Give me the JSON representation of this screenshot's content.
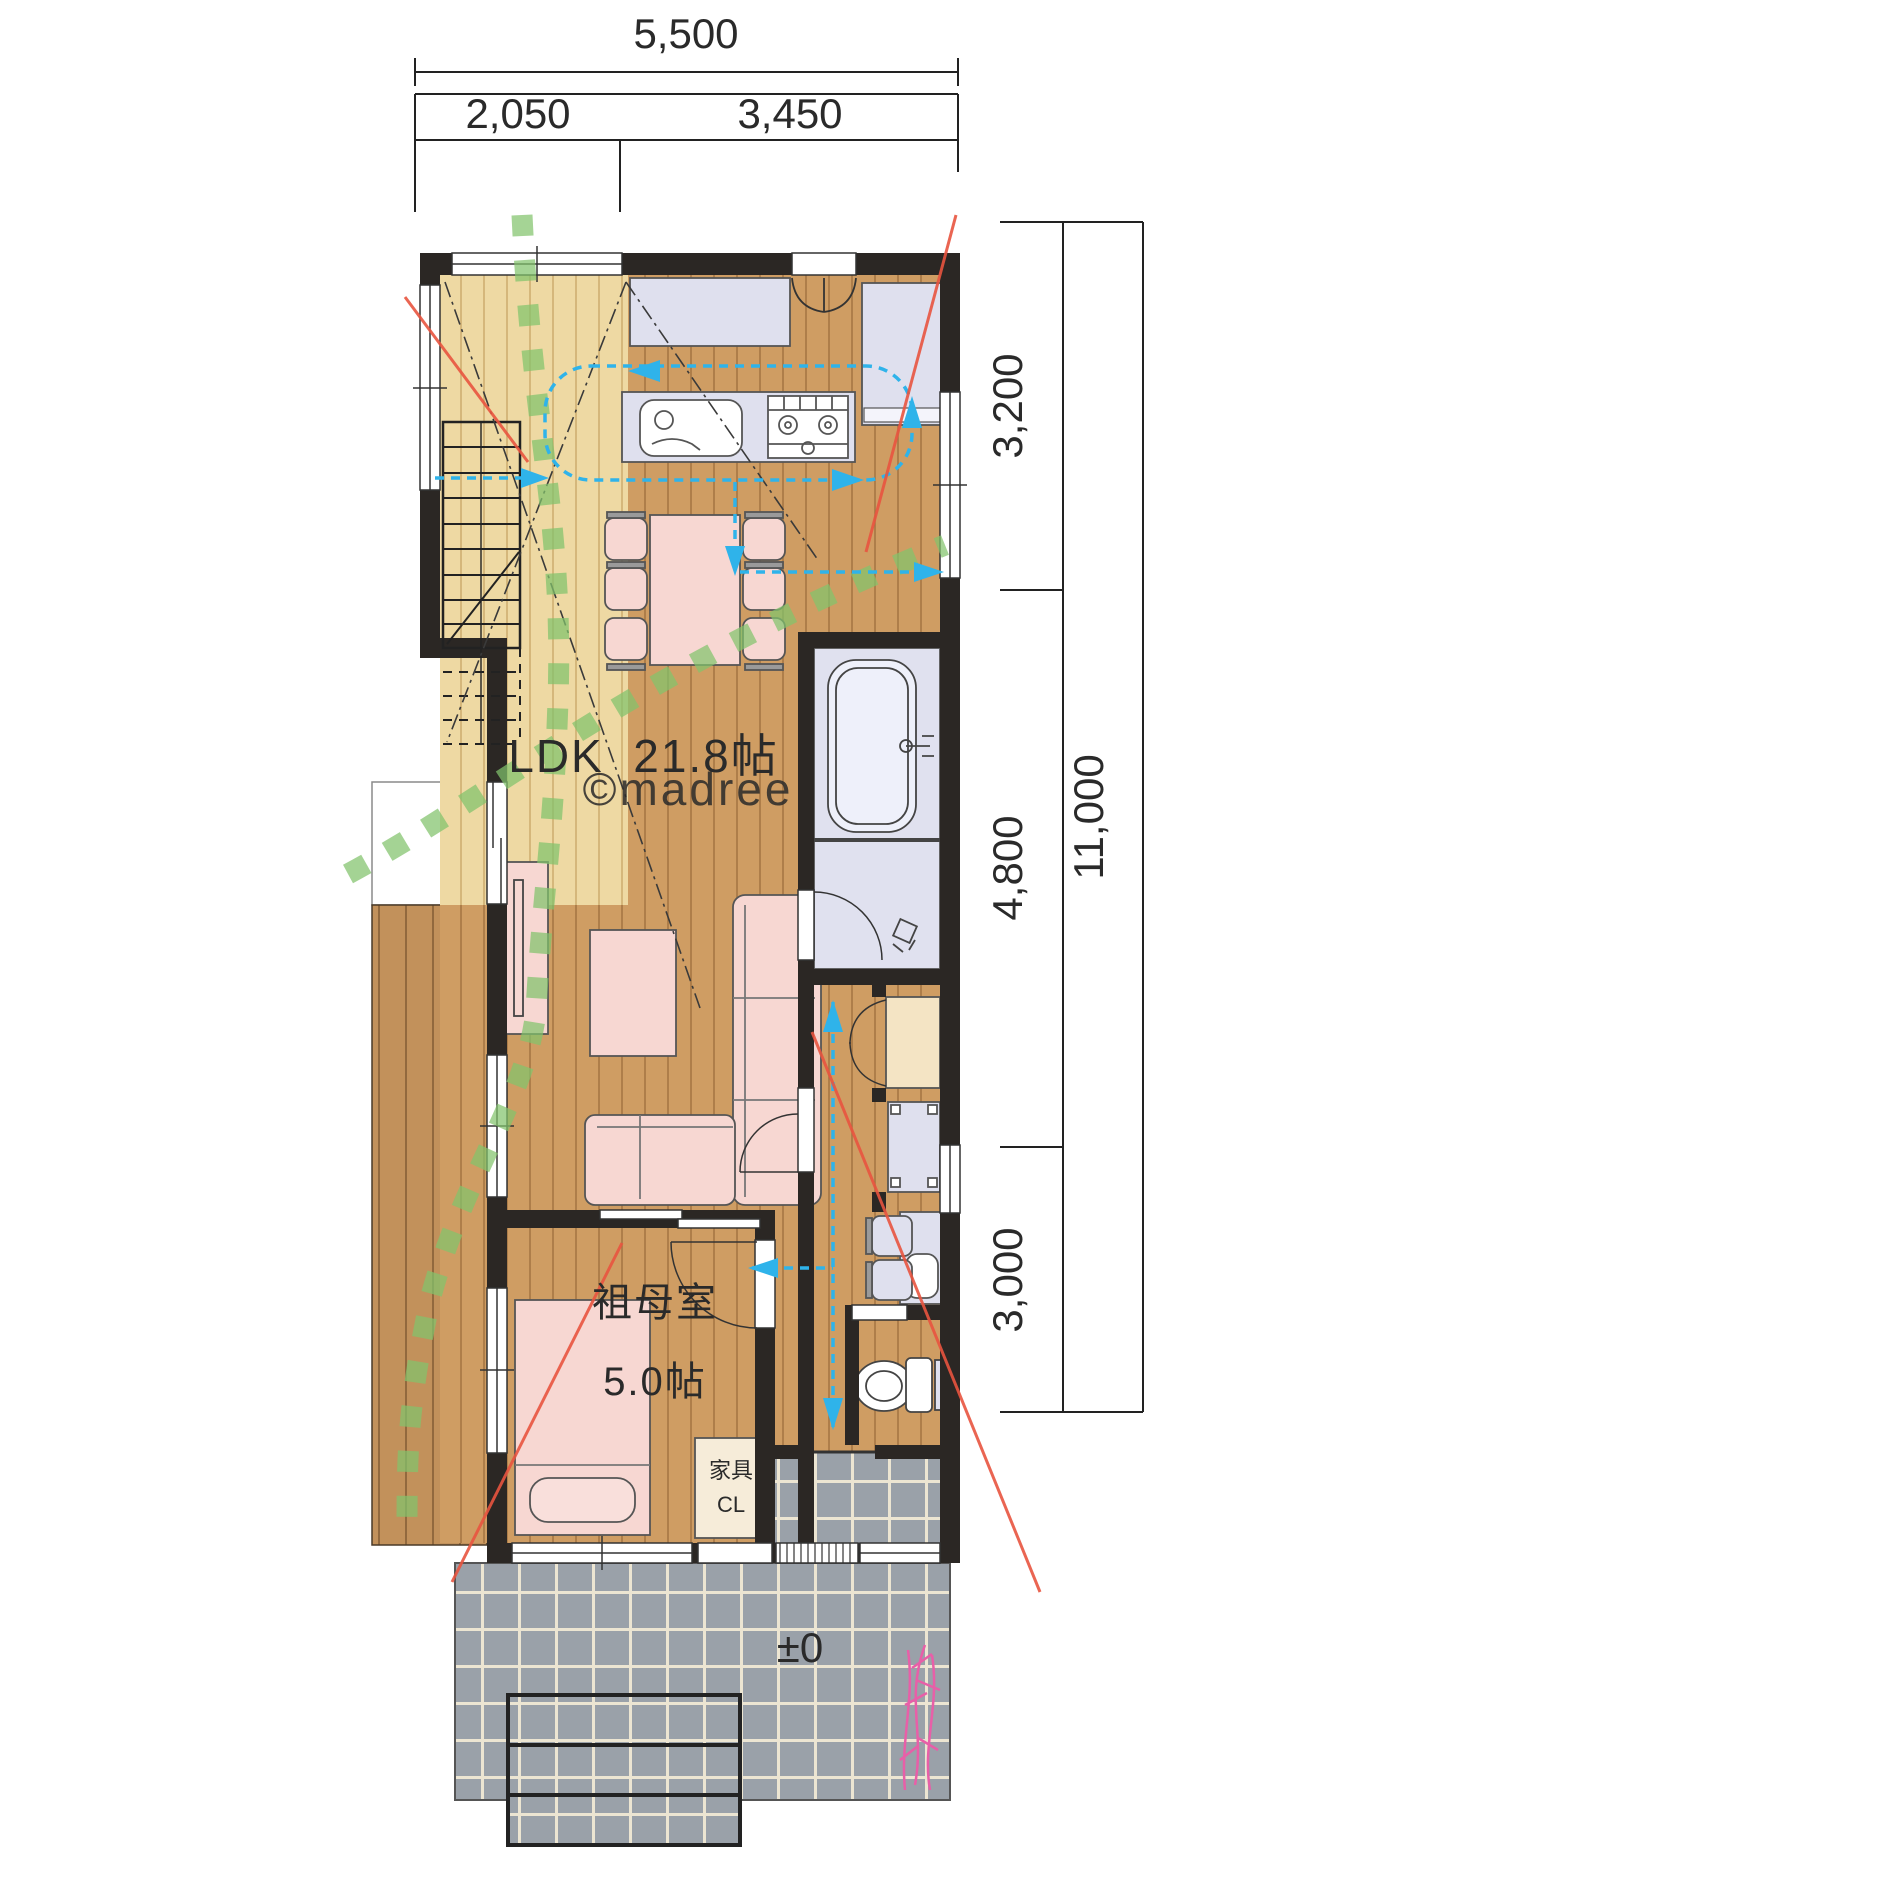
{
  "watermark": "©madree",
  "dimensions": {
    "top_total": "5,500",
    "top_left": "2,050",
    "top_right": "3,450",
    "right_top": "3,200",
    "right_middle": "4,800",
    "right_bottom": "3,000",
    "right_total": "11,000"
  },
  "rooms": {
    "ldk_label": "LDK",
    "ldk_size": "21.8帖",
    "grandmother_label": "祖母室",
    "grandmother_size": "5.0帖",
    "closet_line1": "家具",
    "closet_line2": "CL",
    "entrance_level": "±0"
  },
  "colors": {
    "wall": "#2b2724",
    "floor_light": "#eed9a3",
    "floor_wood": "#cf9d63",
    "deck": "#c2915b",
    "tile_gray": "#9aa1a9",
    "fixture_lavender": "#dfe0ee",
    "furniture_pink": "#f7d7d2",
    "closet_beige": "#f4e4c4",
    "path_green": "#82c36c",
    "flow_blue": "#2fb3ea",
    "accent_red": "#e8543f",
    "plant_pink": "#e85fa8",
    "watermark_gray": "#b6bcc4"
  }
}
